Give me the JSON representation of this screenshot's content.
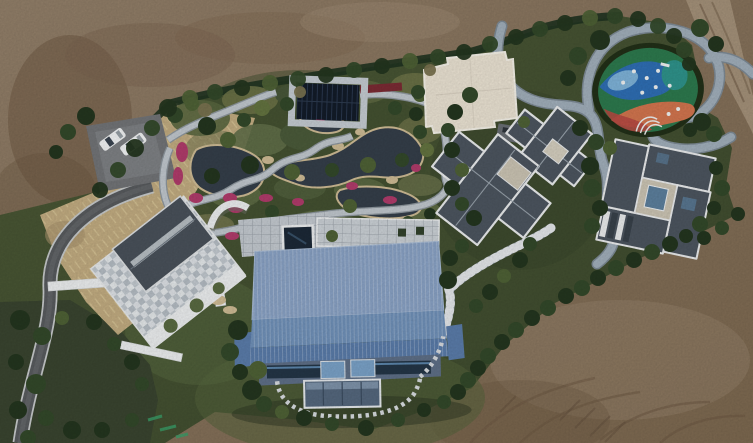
{
  "scene": {
    "type": "aerial-drone-photo",
    "description": "Top-down aerial drone photograph of a landscaped private estate surrounded by bare graded dirt: a large blue metal-roofed main house, a mosaic-roofed house with white terraces, two dark gray cross-shaped and pinwheel-shaped buildings, a white flat-roofed building, winding koi ponds with magenta flower beds, stone paths, a colorful children's playground, a parking area with two white cars and a curving asphalt driveway",
    "objects": {
      "buildings": [
        "main-house-blue-roof",
        "left-house-mosaic-roof",
        "cross-plan-guest-house",
        "pinwheel-plan-house",
        "white-flat-roof-building",
        "glass-pavilion"
      ],
      "car_count": 2,
      "features": [
        "koi-ponds",
        "stone-garden-paths",
        "magenta-flower-beds",
        "playground",
        "winding-gray-road",
        "stepped-walkway",
        "parking-area",
        "asphalt-driveway",
        "swimming-pool",
        "stone-patio",
        "hedge-boundary",
        "bare-dirt-grading",
        "dirt-road",
        "tire-tracks",
        "survey-paint-marks"
      ]
    },
    "palette": {
      "dirt": "#8a7560",
      "dirt_dark": "#6b553f",
      "dirt_light": "#a5927a",
      "track": "#6d5843",
      "lawn": "#46542f",
      "lawn_dark": "#36432a",
      "lawn_light": "#55653c",
      "scrub": "#3a4530",
      "dry": "#c3ad82",
      "straw": "#e2d2a0",
      "hedge": "#1f3320",
      "t_dark": "#24361f",
      "t_mid": "#33492a",
      "t_olive": "#4f6236",
      "t_light": "#647440",
      "t_brown": "#7a7350",
      "water": "#353f4a",
      "rock": "#d0bd96",
      "path": "#c2c9cf",
      "path_edge": "#8f989f",
      "road": "#a2b0bc",
      "road_case": "#7e8b96",
      "asphalt": "#595c5f",
      "asphalt_edge": "#c9cccd",
      "wall": "#eef0f1",
      "plaza": "#c5cbd1",
      "roof1": "#8aa3c6",
      "roof2": "#7192ba",
      "roof3": "#5b7dab",
      "facade": "#5f7088",
      "glassd": "#243647",
      "glassl": "#7ba3c9",
      "glassbox": "#55687e",
      "roofg": "#4d5660",
      "trim": "#eceeef",
      "flat": "#cdc6b5",
      "mosaic1": "#ccd3d8",
      "gable": "#4a525b",
      "pav": "#131c29",
      "pavframe": "#c6cdd3",
      "whitebldg": "#ece4d4",
      "pool": "#1c2937",
      "flower": "#b23c6c",
      "flower2": "#7c2b34",
      "pg": "#2d7a4e",
      "pb": "#2f6fb5",
      "plb": "#7fb4da",
      "pt": "#2f948c",
      "po": "#d4764f",
      "pr": "#b84a42",
      "pring": "#223018",
      "car": "#f4f6f7",
      "carglass": "#3a4450",
      "paint": "#3aa06a",
      "sky": "#5d809e"
    }
  }
}
